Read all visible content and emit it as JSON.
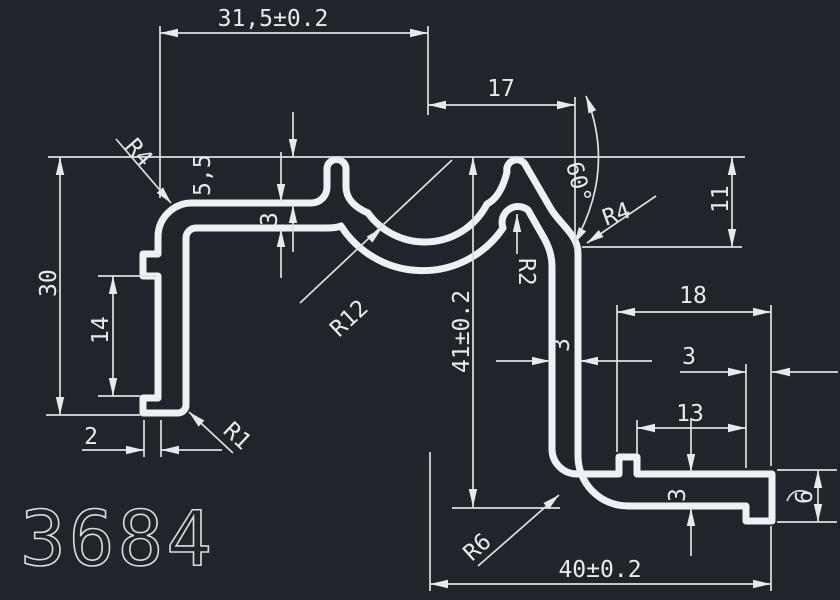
{
  "app": {
    "type": "cad-drawing-viewer",
    "background_color": "#21252b",
    "line_color": "#eef1f4"
  },
  "drawing": {
    "part_number": "3684",
    "dimensions": {
      "top_width": "31,5±0.2",
      "groove_center_to_right": "17",
      "slant_angle": "60°",
      "top_left_corner_radius": "R4",
      "finger_height": "5,5",
      "top_wall_thickness": "3",
      "left_height": "30",
      "tab_spacing": "14",
      "tab_depth": "2",
      "left_bottom_radius": "R1",
      "groove_radius": "R12",
      "total_height": "41±0.2",
      "peak_inner_radius": "R2",
      "right_corner_radius": "R4",
      "right_top_height": "11",
      "right_wall_thickness": "3",
      "flange_width": "18",
      "foot_width": "3",
      "notch_to_foot": "13",
      "arm_thickness": "3",
      "foot_height": "6",
      "bottom_corner_radius": "R6",
      "bottom_width": "40±0.2"
    }
  }
}
